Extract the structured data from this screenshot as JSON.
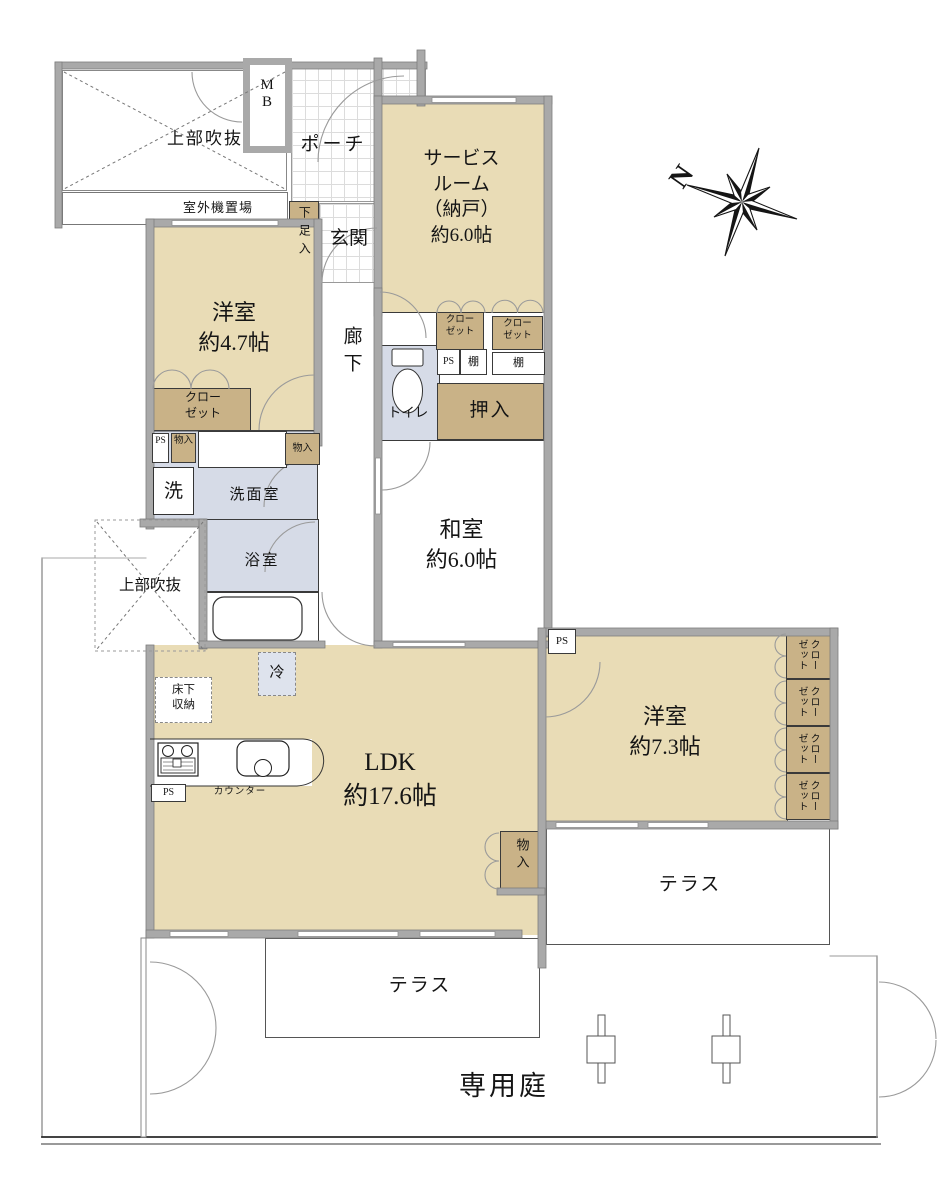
{
  "labels": {
    "void_upper": "上部吹抜",
    "outdoor_unit": "室外機置場",
    "meter_box": "MB",
    "porch": "ポーチ",
    "shoe_box": "下足入",
    "entrance": "玄関",
    "service_line1": "サービス",
    "service_line2": "ルーム",
    "service_line3": "（納戸）",
    "service_line4": "約6.0帖",
    "west_room_47_name": "洋室",
    "west_room_47_size": "約4.7帖",
    "corridor": "廊下",
    "toilet": "トイレ",
    "closet_line1": "クロー",
    "closet_line2": "ゼット",
    "shelf": "棚",
    "ps": "PS",
    "oshiire": "押入",
    "storage": "物入",
    "washer": "洗",
    "washroom": "洗面室",
    "bathroom": "浴室",
    "void_left": "上部吹抜",
    "japanese_room_name": "和室",
    "japanese_room_size": "約6.0帖",
    "west_room_73_name": "洋室",
    "west_room_73_size": "約7.3帖",
    "closet_vertical": "クローゼット",
    "ldk_name": "LDK",
    "ldk_size": "約17.6帖",
    "fridge": "冷",
    "underfloor_line1": "床下",
    "underfloor_line2": "収納",
    "counter": "カウンター",
    "terrace": "テラス",
    "private_garden": "専用庭",
    "compass_north": "N"
  },
  "colors": {
    "room": "#e9dcb6",
    "closet": "#c9b287",
    "wet_area": "#d6dbe7",
    "wall": "#a9a9a9"
  }
}
